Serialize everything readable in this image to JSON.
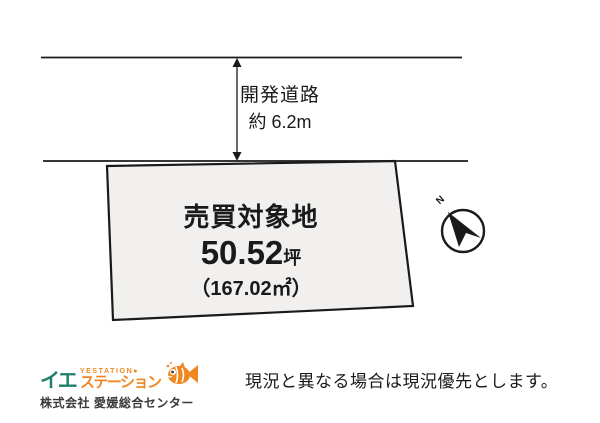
{
  "colors": {
    "ink": "#1a1a1a",
    "parcel_fill": "#f1f0ee",
    "logo_teal": "#1e7f68",
    "logo_orange": "#f0861f",
    "company_text": "#3a3a3a"
  },
  "road": {
    "name": "開発道路",
    "width_label": "約 6.2m"
  },
  "parcel": {
    "title": "売買対象地",
    "area_tsubo_value": "50.52",
    "area_tsubo_unit": "坪",
    "area_sqm": "（167.02㎡）"
  },
  "compass": {
    "north_label": "N"
  },
  "footer": {
    "logo": {
      "katakana_ie": "イエ",
      "latin_small": "YESTATION●",
      "katakana_station": "ステーション",
      "company_name": "株式会社 愛媛総合センター"
    },
    "disclaimer": "現況と異なる場合は現況優先とします。"
  }
}
